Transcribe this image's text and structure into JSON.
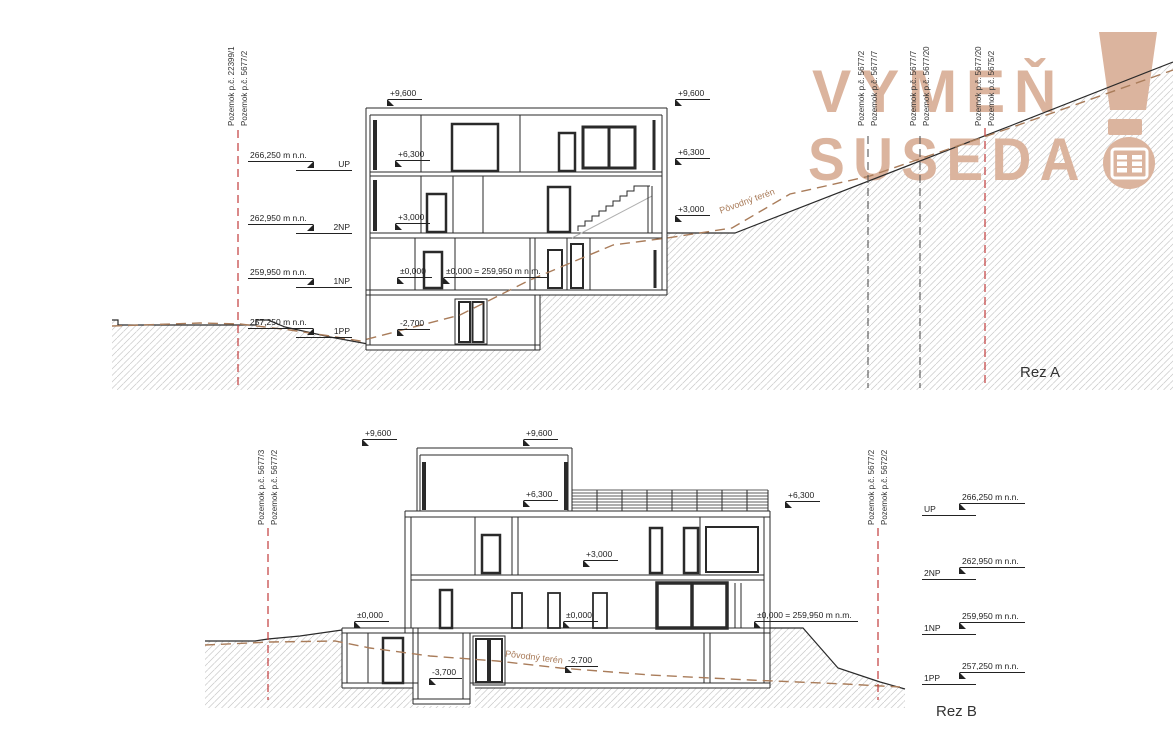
{
  "watermark": {
    "line1": "VYMEŇ",
    "line2": "SUSEDA",
    "color": "#dbb49e"
  },
  "colors": {
    "parcel_line_red": "#c23b3b",
    "parcel_line_dark": "#555555",
    "terrain_brown": "#a97c5a",
    "hatch": "#c9c9c9",
    "line": "#2a2a2a"
  },
  "a": {
    "title": "Rez A",
    "parcels": [
      {
        "l": "Pozemok p.č. 22399/1",
        "r": "Pozemok p.č. 5677/2"
      },
      {
        "l": "Pozemok p.č. 5677/2",
        "r": "Pozemok p.č. 5677/7"
      },
      {
        "l": "Pozemok p.č. 5677/7",
        "r": "Pozemok p.č. 5677/20"
      },
      {
        "l": "Pozemok p.č. 5677/20",
        "r": "Pozemok p.č. 5675/2"
      }
    ],
    "levels": [
      {
        "value": "266,250 m n.n.",
        "name": "UP"
      },
      {
        "value": "262,950 m n.n.",
        "name": "2NP"
      },
      {
        "value": "259,950 m n.n.",
        "name": "1NP"
      },
      {
        "value": "257,250 m n.n.",
        "name": "1PP"
      }
    ],
    "marks": {
      "p9600": "+9,600",
      "p6300": "+6,300",
      "p3000": "+3,000",
      "zero": "±0,000",
      "zero_eq": "±0,000 = 259,950 m n.m.",
      "m2700": "-2,700"
    },
    "terrain": "Pôvodný terén"
  },
  "b": {
    "title": "Rez B",
    "parcels": [
      {
        "l": "Pozemok p.č. 5677/3",
        "r": "Pozemok p.č. 5677/2"
      },
      {
        "l": "Pozemok p.č. 5677/2",
        "r": "Pozemok p.č. 5672/2"
      }
    ],
    "levels": [
      {
        "value": "266,250 m n.n.",
        "name": "UP"
      },
      {
        "value": "262,950 m n.n.",
        "name": "2NP"
      },
      {
        "value": "259,950 m n.n.",
        "name": "1NP"
      },
      {
        "value": "257,250 m n.n.",
        "name": "1PP"
      }
    ],
    "marks": {
      "p9600": "+9,600",
      "p6300": "+6,300",
      "p3000": "+3,000",
      "zero": "±0,000",
      "zero_eq": "±0,000 = 259,950 m n.m.",
      "m2700": "-2,700",
      "m3700": "-3,700"
    },
    "terrain": "Pôvodný terén"
  }
}
